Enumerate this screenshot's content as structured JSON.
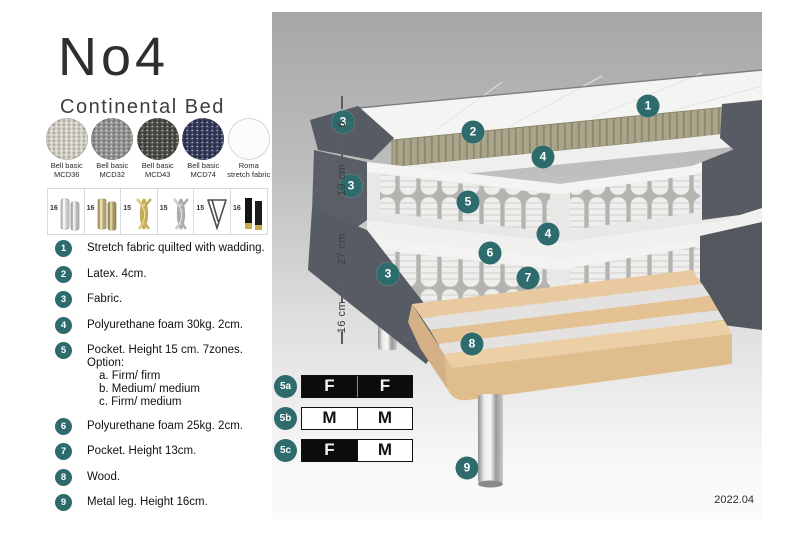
{
  "header": {
    "title": "No4",
    "subtitle": "Continental Bed"
  },
  "colors": {
    "teal": "#2e6b6d",
    "dark_fabric": "#575c64",
    "latex": "#a9a489",
    "wood": "#e7c79b",
    "panel_gradient_top": "#a6a6a6",
    "panel_gradient_bottom": "#fbfbfb"
  },
  "fabrics": [
    {
      "line1": "Bell basic",
      "line2": "MCD36",
      "base": "#d9d6cd",
      "dot": "#b3afa2"
    },
    {
      "line1": "Bell basic",
      "line2": "MCD32",
      "base": "#9c9c9a",
      "dot": "#7b7b79"
    },
    {
      "line1": "Bell basic",
      "line2": "MCD43",
      "base": "#56564f",
      "dot": "#3d3d38"
    },
    {
      "line1": "Bell basic",
      "line2": "MCD74",
      "base": "#3d4566",
      "dot": "#282e47"
    },
    {
      "line1": "Roma",
      "line2": "stretch fabric",
      "base": "#fcfcfc",
      "dot": "#f0f0f0"
    }
  ],
  "legs": [
    {
      "height": "16",
      "style": "cylinder-silver"
    },
    {
      "height": "16",
      "style": "cylinder-brass"
    },
    {
      "height": "15",
      "style": "twist-gold"
    },
    {
      "height": "15",
      "style": "twist-silver"
    },
    {
      "height": "15",
      "style": "hairpin"
    },
    {
      "height": "16",
      "style": "black-gold"
    }
  ],
  "features": [
    {
      "num": "1",
      "text": "Stretch fabric quilted with wadding."
    },
    {
      "num": "2",
      "text": "Latex. 4cm."
    },
    {
      "num": "3",
      "text": "Fabric."
    },
    {
      "num": "4",
      "text": "Polyurethane foam 30kg. 2cm."
    },
    {
      "num": "5",
      "text": "Pocket. Height 15 cm. 7zones. Option:",
      "options": [
        "a. Firm/ firm",
        "b. Medium/ medium",
        "c. Firm/ medium"
      ]
    },
    {
      "num": "6",
      "text": "Polyurethane foam 25kg. 2cm."
    },
    {
      "num": "7",
      "text": "Pocket. Height 13cm."
    },
    {
      "num": "8",
      "text": "Wood."
    },
    {
      "num": "9",
      "text": "Metal leg. Height 16cm."
    }
  ],
  "diagram": {
    "callouts": [
      {
        "label": "1",
        "x": 376,
        "y": 94
      },
      {
        "label": "2",
        "x": 201,
        "y": 120
      },
      {
        "label": "3",
        "x": 71,
        "y": 110
      },
      {
        "label": "3",
        "x": 79,
        "y": 174
      },
      {
        "label": "3",
        "x": 116,
        "y": 262
      },
      {
        "label": "4",
        "x": 271,
        "y": 145
      },
      {
        "label": "4",
        "x": 276,
        "y": 222
      },
      {
        "label": "5",
        "x": 196,
        "y": 190
      },
      {
        "label": "6",
        "x": 218,
        "y": 241
      },
      {
        "label": "7",
        "x": 256,
        "y": 266
      },
      {
        "label": "8",
        "x": 200,
        "y": 332
      },
      {
        "label": "9",
        "x": 195,
        "y": 456
      }
    ],
    "dimensions": [
      {
        "label": "6",
        "y1": 84,
        "y2": 140
      },
      {
        "label": "19 cm",
        "y1": 140,
        "y2": 196
      },
      {
        "label": "27 cm",
        "y1": 196,
        "y2": 278
      },
      {
        "label": "16 cm",
        "y1": 278,
        "y2": 332
      }
    ],
    "firmness": [
      {
        "label": "5a",
        "cells": [
          "F",
          "F"
        ],
        "dark": [
          true,
          true
        ]
      },
      {
        "label": "5b",
        "cells": [
          "M",
          "M"
        ],
        "dark": [
          false,
          false
        ]
      },
      {
        "label": "5c",
        "cells": [
          "F",
          "M"
        ],
        "dark": [
          true,
          false
        ]
      }
    ],
    "version": "2022.04"
  }
}
